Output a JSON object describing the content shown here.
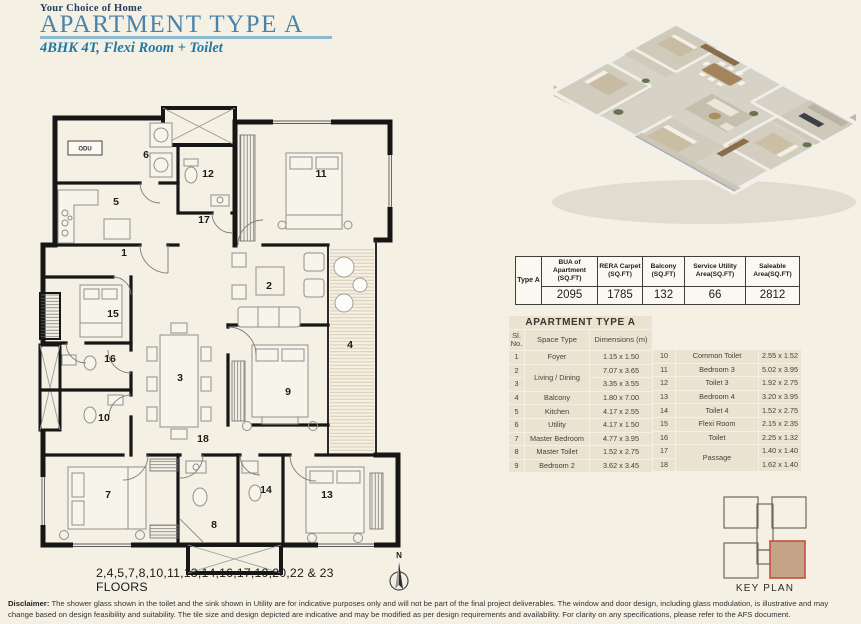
{
  "header": {
    "eyebrow": "Your Choice of Home",
    "title": "APARTMENT TYPE A",
    "subtitle": "4BHK 4T, Flexi Room + Toilet"
  },
  "plan": {
    "rooms": [
      "1",
      "2",
      "3",
      "4",
      "5",
      "6",
      "7",
      "8",
      "9",
      "10",
      "11",
      "12",
      "13",
      "14",
      "15",
      "16",
      "17",
      "18"
    ],
    "odu": "ODU",
    "floors_note": "2,4,5,7,8,10,11,13,14,16,17,19,20,22 & 23 FLOORS",
    "compass": "N"
  },
  "area_table": {
    "row_label": "Type A",
    "headers": [
      "BUA of Apartment (SQ.FT)",
      "RERA Carpet (SQ.FT)",
      "Balcony (SQ.FT)",
      "Service Utility Area(SQ.FT)",
      "Saleable Area(SQ.FT)"
    ],
    "values": [
      "2095",
      "1785",
      "132",
      "66",
      "2812"
    ]
  },
  "dim_table": {
    "title": "APARTMENT TYPE A",
    "col_sl": "Sl. No.",
    "col_space": "Space Type",
    "col_dim": "Dimensions (m)",
    "left": [
      {
        "no": "1",
        "space": "Foyer",
        "dim": "1.15 x 1.50"
      },
      {
        "no": "2",
        "space": "Living / Dining",
        "dim": "7.07 x 3.65"
      },
      {
        "no": "3",
        "dim": "3.35 x 3.55"
      },
      {
        "no": "4",
        "space": "Balcony",
        "dim": "1.80 x 7.00"
      },
      {
        "no": "5",
        "space": "Kitchen",
        "dim": "4.17 x 2.55"
      },
      {
        "no": "6",
        "space": "Utility",
        "dim": "4.17 x 1.50"
      },
      {
        "no": "7",
        "space": "Master Bedroom",
        "dim": "4.77 x 3.95"
      },
      {
        "no": "8",
        "space": "Master Toilet",
        "dim": "1.52 x 2.75"
      },
      {
        "no": "9",
        "space": "Bedroom 2",
        "dim": "3.62 x 3.45"
      }
    ],
    "right": [
      {
        "no": "10",
        "space": "Common Toilet",
        "dim": "2.55 x 1.52"
      },
      {
        "no": "11",
        "space": "Bedroom 3",
        "dim": "5.02 x 3.95"
      },
      {
        "no": "12",
        "space": "Toilet 3",
        "dim": "1.92 x 2.75"
      },
      {
        "no": "13",
        "space": "Bedroom 4",
        "dim": "3.20 x 3.95"
      },
      {
        "no": "14",
        "space": "Toilet 4",
        "dim": "1.52 x 2.75"
      },
      {
        "no": "15",
        "space": "Flexi Room",
        "dim": "2.15 x 2.35"
      },
      {
        "no": "16",
        "space": "Toilet",
        "dim": "2.25 x 1.32"
      },
      {
        "no": "17",
        "space": "Passage",
        "dim": "1.40 x 1.40"
      },
      {
        "no": "18",
        "dim": "1.62 x 1.40"
      }
    ]
  },
  "key_plan": {
    "label": "KEY PLAN"
  },
  "disclaimer": {
    "label": "Disclaimer:",
    "text": "The shower glass shown in the toilet and the sink shown in Utility are for indicative purposes only and will not be part of the final project deliverables. The window and door design, including glass modulation, is illustrative and may change based on design feasibility and suitability. The tile size and design depicted are indicative and may be modified as per design requirements and availability. For clarity on any specifications, please refer to the AFS document."
  },
  "colors": {
    "accent_title": "#4a82a8",
    "accent_subtitle": "#2079a4",
    "eyebrow": "#24405e",
    "underline": "#8cb8d0",
    "table_cell": "#ebe3d1",
    "keyplan_fill": "#c5a387",
    "keyplan_stroke": "#c7503a"
  }
}
